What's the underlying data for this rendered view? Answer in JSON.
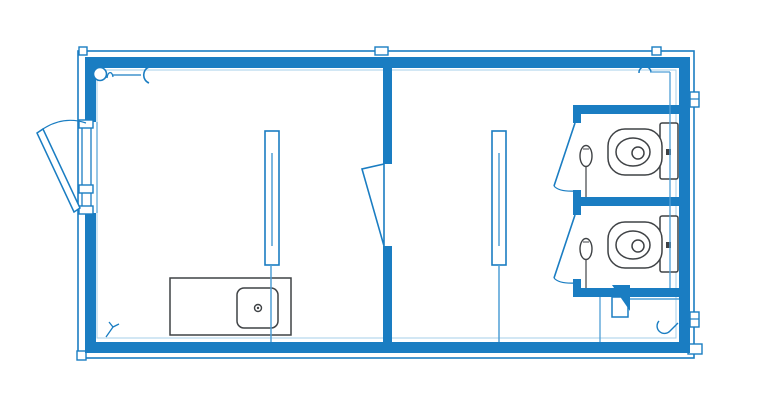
{
  "canvas": {
    "width": 768,
    "height": 420,
    "background": "#ffffff"
  },
  "palette": {
    "wall_blue": "#1a7dc2",
    "line_blue": "#4f9fd6",
    "faint_blue": "#a6cfe9",
    "fixture_gray": "#3f4245",
    "white": "#ffffff",
    "none": "none"
  },
  "floorplan": {
    "elements": [
      {
        "name": "outer-frame",
        "type": "rect",
        "x": 78,
        "y": 51,
        "w": 616,
        "h": 307,
        "stroke": "wall_blue",
        "sw": 1.6,
        "fill": "none"
      },
      {
        "name": "corner-joint-top-left",
        "type": "rect",
        "x": 79,
        "y": 47,
        "w": 8,
        "h": 8,
        "stroke": "wall_blue",
        "sw": 1.4,
        "fill": "white"
      },
      {
        "name": "joint-top-partition",
        "type": "rect",
        "x": 375,
        "y": 47,
        "w": 13,
        "h": 8,
        "stroke": "wall_blue",
        "sw": 1.4,
        "fill": "white"
      },
      {
        "name": "joint-top-right",
        "type": "rect",
        "x": 652,
        "y": 47,
        "w": 9,
        "h": 8,
        "stroke": "wall_blue",
        "sw": 1.4,
        "fill": "white"
      },
      {
        "name": "corner-joint-bottom-left",
        "type": "rect",
        "x": 77,
        "y": 351,
        "w": 9,
        "h": 9,
        "stroke": "wall_blue",
        "sw": 1.4,
        "fill": "white"
      },
      {
        "name": "corner-cap-bottom-right",
        "type": "rect",
        "x": 688,
        "y": 344,
        "w": 14,
        "h": 10,
        "stroke": "wall_blue",
        "sw": 1.4,
        "fill": "white"
      },
      {
        "name": "bracket-right-top",
        "type": "rect",
        "x": 690,
        "y": 92,
        "w": 9,
        "h": 15,
        "stroke": "wall_blue",
        "sw": 1.4,
        "fill": "white"
      },
      {
        "name": "bracket-right-top-line",
        "type": "line",
        "x1": 690,
        "y1": 99,
        "x2": 699,
        "y2": 99,
        "stroke": "wall_blue",
        "sw": 1.2
      },
      {
        "name": "bracket-right-bottom",
        "type": "rect",
        "x": 690,
        "y": 312,
        "w": 9,
        "h": 15,
        "stroke": "wall_blue",
        "sw": 1.4,
        "fill": "white"
      },
      {
        "name": "bracket-right-bottom-line",
        "type": "line",
        "x1": 690,
        "y1": 319,
        "x2": 699,
        "y2": 319,
        "stroke": "wall_blue",
        "sw": 1.2
      },
      {
        "name": "wall-top",
        "type": "rect",
        "x": 85,
        "y": 57,
        "w": 605,
        "h": 11,
        "fill": "wall_blue"
      },
      {
        "name": "wall-bottom",
        "type": "rect",
        "x": 85,
        "y": 342,
        "w": 605,
        "h": 11,
        "fill": "wall_blue"
      },
      {
        "name": "wall-left-upper",
        "type": "rect",
        "x": 85,
        "y": 57,
        "w": 11,
        "h": 65,
        "fill": "wall_blue"
      },
      {
        "name": "wall-left-lower",
        "type": "rect",
        "x": 85,
        "y": 213,
        "w": 11,
        "h": 140,
        "fill": "wall_blue"
      },
      {
        "name": "wall-right",
        "type": "rect",
        "x": 679,
        "y": 57,
        "w": 11,
        "h": 296,
        "fill": "wall_blue"
      },
      {
        "name": "inner-wall-face",
        "type": "rect",
        "x": 97,
        "y": 70,
        "w": 579,
        "h": 268,
        "stroke": "faint_blue",
        "sw": 1,
        "fill": "none"
      },
      {
        "name": "partition-wall-upper",
        "type": "rect",
        "x": 383,
        "y": 57,
        "w": 9,
        "h": 107,
        "fill": "wall_blue"
      },
      {
        "name": "partition-wall-lower",
        "type": "rect",
        "x": 383,
        "y": 246,
        "w": 9,
        "h": 107,
        "fill": "wall_blue"
      },
      {
        "name": "partition-door-leaf",
        "type": "polygon",
        "points": "384,164 362,169 384,246",
        "stroke": "wall_blue",
        "sw": 1.6,
        "fill": "white"
      },
      {
        "name": "stall-wall-top",
        "type": "rect",
        "x": 573,
        "y": 105,
        "w": 106,
        "h": 9,
        "fill": "wall_blue"
      },
      {
        "name": "stall-wall-top-post",
        "type": "rect",
        "x": 573,
        "y": 105,
        "w": 8,
        "h": 18,
        "fill": "wall_blue"
      },
      {
        "name": "stall-wall-middle",
        "type": "rect",
        "x": 573,
        "y": 197,
        "w": 106,
        "h": 9,
        "fill": "wall_blue"
      },
      {
        "name": "stall-wall-middle-post",
        "type": "rect",
        "x": 573,
        "y": 190,
        "w": 8,
        "h": 25,
        "fill": "wall_blue"
      },
      {
        "name": "stall-wall-bottom",
        "type": "rect",
        "x": 573,
        "y": 288,
        "w": 106,
        "h": 9,
        "fill": "wall_blue"
      },
      {
        "name": "stall-wall-bottom-post",
        "type": "rect",
        "x": 573,
        "y": 279,
        "w": 8,
        "h": 18,
        "fill": "wall_blue"
      },
      {
        "name": "stall1-door-leaf",
        "type": "line",
        "x1": 575,
        "y1": 123,
        "x2": 554,
        "y2": 186,
        "stroke": "wall_blue",
        "sw": 1.6
      },
      {
        "name": "stall1-door-swing",
        "type": "path",
        "d": "M554,186 Q559,192 576,191",
        "stroke": "wall_blue",
        "sw": 1.2,
        "fill": "none"
      },
      {
        "name": "stall2-door-leaf",
        "type": "line",
        "x1": 575,
        "y1": 215,
        "x2": 554,
        "y2": 278,
        "stroke": "wall_blue",
        "sw": 1.6
      },
      {
        "name": "stall2-door-swing",
        "type": "path",
        "d": "M554,278 Q559,284 576,283",
        "stroke": "wall_blue",
        "sw": 1.2,
        "fill": "none"
      },
      {
        "name": "entry-door-jamb",
        "type": "rect",
        "x": 82,
        "y": 122,
        "w": 9,
        "h": 91,
        "stroke": "wall_blue",
        "sw": 1.3,
        "fill": "white"
      },
      {
        "name": "entry-door-inner-line",
        "type": "line",
        "x1": 97,
        "y1": 122,
        "x2": 97,
        "y2": 213,
        "stroke": "line_blue",
        "sw": 1.2
      },
      {
        "name": "entry-door-hinge-top",
        "type": "rect",
        "x": 79,
        "y": 120,
        "w": 14,
        "h": 8,
        "stroke": "wall_blue",
        "sw": 1.4,
        "fill": "white"
      },
      {
        "name": "entry-door-hinge-middle",
        "type": "rect",
        "x": 79,
        "y": 185,
        "w": 14,
        "h": 8,
        "stroke": "wall_blue",
        "sw": 1.4,
        "fill": "white"
      },
      {
        "name": "entry-door-hinge-bottom",
        "type": "rect",
        "x": 79,
        "y": 206,
        "w": 14,
        "h": 8,
        "stroke": "wall_blue",
        "sw": 1.4,
        "fill": "white"
      },
      {
        "name": "entry-door-leaf",
        "type": "polygon",
        "points": "37,133 43,129 80,208 74,212",
        "stroke": "wall_blue",
        "sw": 1.5,
        "fill": "white"
      },
      {
        "name": "entry-door-swing",
        "type": "path",
        "d": "M40,131 Q62,115 86,123",
        "stroke": "wall_blue",
        "sw": 1.2,
        "fill": "none"
      },
      {
        "name": "lamp-symbol-circle",
        "type": "circle",
        "cx": 100,
        "cy": 74,
        "r": 6.5,
        "stroke": "wall_blue",
        "sw": 1.6,
        "fill": "white"
      },
      {
        "name": "lamp-symbol-squiggle",
        "type": "path",
        "d": "M107,78 c1,-7 5,-7 6,-1",
        "stroke": "wall_blue",
        "sw": 1.3,
        "fill": "none"
      },
      {
        "name": "lamp-symbol-lead",
        "type": "line",
        "x1": 113,
        "y1": 75,
        "x2": 141,
        "y2": 75,
        "stroke": "wall_blue",
        "sw": 1.3
      },
      {
        "name": "connection-bracket-symbol",
        "type": "path",
        "d": "M149,67 a8,8.5 0 0 0 0,16",
        "stroke": "wall_blue",
        "sw": 1.6,
        "fill": "none"
      },
      {
        "name": "socket-symbol-top-right",
        "type": "path",
        "d": "M639,73 a6,6 0 0 1 12,-1",
        "stroke": "wall_blue",
        "sw": 1.5,
        "fill": "none"
      },
      {
        "name": "socket-lead-top-right",
        "type": "line",
        "x1": 650,
        "y1": 72,
        "x2": 670,
        "y2": 72,
        "stroke": "line_blue",
        "sw": 1.2
      },
      {
        "name": "light-fixture-left",
        "type": "rect",
        "x": 265,
        "y": 131,
        "w": 14,
        "h": 134,
        "stroke": "wall_blue",
        "sw": 1.6,
        "fill": "white"
      },
      {
        "name": "light-fixture-left-tube",
        "type": "line",
        "x1": 272,
        "y1": 153,
        "x2": 272,
        "y2": 246,
        "stroke": "line_blue",
        "sw": 1.5
      },
      {
        "name": "light-fixture-right",
        "type": "rect",
        "x": 492,
        "y": 131,
        "w": 14,
        "h": 134,
        "stroke": "wall_blue",
        "sw": 1.6,
        "fill": "white"
      },
      {
        "name": "light-fixture-right-tube",
        "type": "line",
        "x1": 499,
        "y1": 153,
        "x2": 499,
        "y2": 246,
        "stroke": "line_blue",
        "sw": 1.5
      },
      {
        "name": "counter",
        "type": "rect",
        "x": 170,
        "y": 278,
        "w": 121,
        "h": 57,
        "stroke": "fixture_gray",
        "sw": 1.5,
        "fill": "white"
      },
      {
        "name": "sink-basin",
        "type": "rect",
        "x": 237,
        "y": 288,
        "w": 41,
        "h": 40,
        "rx": 7,
        "stroke": "fixture_gray",
        "sw": 1.5,
        "fill": "white"
      },
      {
        "name": "sink-drain",
        "type": "circle",
        "cx": 258,
        "cy": 308,
        "r": 3.5,
        "stroke": "fixture_gray",
        "sw": 1.4,
        "fill": "white"
      },
      {
        "name": "sink-drain-dot",
        "type": "circle",
        "cx": 258,
        "cy": 308,
        "r": 1.2,
        "fill": "fixture_gray"
      },
      {
        "name": "toilet1-cistern",
        "type": "rect",
        "x": 660,
        "y": 123,
        "w": 18,
        "h": 56,
        "rx": 2,
        "stroke": "fixture_gray",
        "sw": 1.5,
        "fill": "white"
      },
      {
        "name": "toilet1-bowl",
        "type": "rect",
        "x": 608,
        "y": 129,
        "w": 54,
        "h": 46,
        "rx": 17,
        "stroke": "fixture_gray",
        "sw": 1.5,
        "fill": "white"
      },
      {
        "name": "toilet1-bowl-inner",
        "type": "ellipse",
        "cx": 633,
        "cy": 152,
        "rx": 17,
        "ry": 14,
        "stroke": "fixture_gray",
        "sw": 1.5,
        "fill": "white"
      },
      {
        "name": "toilet1-flush",
        "type": "circle",
        "cx": 638,
        "cy": 153,
        "r": 6,
        "stroke": "fixture_gray",
        "sw": 1.5,
        "fill": "white"
      },
      {
        "name": "toilet1-button",
        "type": "rect",
        "x": 666,
        "y": 149,
        "w": 5,
        "h": 6,
        "fill": "fixture_gray"
      },
      {
        "name": "toilet2-cistern",
        "type": "rect",
        "x": 660,
        "y": 216,
        "w": 18,
        "h": 56,
        "rx": 2,
        "stroke": "fixture_gray",
        "sw": 1.5,
        "fill": "white"
      },
      {
        "name": "toilet2-bowl",
        "type": "rect",
        "x": 608,
        "y": 222,
        "w": 54,
        "h": 46,
        "rx": 17,
        "stroke": "fixture_gray",
        "sw": 1.5,
        "fill": "white"
      },
      {
        "name": "toilet2-bowl-inner",
        "type": "ellipse",
        "cx": 633,
        "cy": 245,
        "rx": 17,
        "ry": 14,
        "stroke": "fixture_gray",
        "sw": 1.5,
        "fill": "white"
      },
      {
        "name": "toilet2-flush",
        "type": "circle",
        "cx": 638,
        "cy": 246,
        "r": 6,
        "stroke": "fixture_gray",
        "sw": 1.5,
        "fill": "white"
      },
      {
        "name": "toilet2-button",
        "type": "rect",
        "x": 666,
        "y": 242,
        "w": 5,
        "h": 6,
        "fill": "fixture_gray"
      },
      {
        "name": "paper-holder1",
        "type": "ellipse",
        "cx": 586,
        "cy": 156,
        "rx": 6,
        "ry": 10.5,
        "stroke": "fixture_gray",
        "sw": 1.4,
        "fill": "white"
      },
      {
        "name": "paper-holder1-notch",
        "type": "line",
        "x1": 583,
        "y1": 149,
        "x2": 589,
        "y2": 149,
        "stroke": "fixture_gray",
        "sw": 1
      },
      {
        "name": "paper-holder1-line",
        "type": "line",
        "x1": 586,
        "y1": 166.5,
        "x2": 586,
        "y2": 197,
        "stroke": "fixture_gray",
        "sw": 1.2
      },
      {
        "name": "paper-holder2",
        "type": "ellipse",
        "cx": 586,
        "cy": 249,
        "rx": 6,
        "ry": 10.5,
        "stroke": "fixture_gray",
        "sw": 1.4,
        "fill": "white"
      },
      {
        "name": "paper-holder2-notch",
        "type": "line",
        "x1": 583,
        "y1": 242,
        "x2": 589,
        "y2": 242,
        "stroke": "fixture_gray",
        "sw": 1
      },
      {
        "name": "paper-holder2-line",
        "type": "line",
        "x1": 586,
        "y1": 259.5,
        "x2": 586,
        "y2": 288,
        "stroke": "fixture_gray",
        "sw": 1.2
      },
      {
        "name": "service-hatch-box",
        "type": "rect",
        "x": 612,
        "y": 297,
        "w": 16,
        "h": 20,
        "stroke": "wall_blue",
        "sw": 1.5,
        "fill": "white"
      },
      {
        "name": "service-hatch-flap",
        "type": "polygon",
        "points": "612,285 630,285 630,311",
        "fill": "wall_blue"
      },
      {
        "name": "service-stub-line",
        "type": "line",
        "x1": 630,
        "y1": 299,
        "x2": 679,
        "y2": 299,
        "stroke": "line_blue",
        "sw": 1.5
      },
      {
        "name": "service-line-left-room",
        "type": "line",
        "x1": 271,
        "y1": 265,
        "x2": 271,
        "y2": 342,
        "stroke": "line_blue",
        "sw": 1.5
      },
      {
        "name": "service-line-right-room",
        "type": "line",
        "x1": 499,
        "y1": 265,
        "x2": 499,
        "y2": 342,
        "stroke": "line_blue",
        "sw": 1.5
      },
      {
        "name": "service-line-stalls",
        "type": "line",
        "x1": 670,
        "y1": 72,
        "x2": 670,
        "y2": 288,
        "stroke": "line_blue",
        "sw": 1.3
      },
      {
        "name": "service-line-hatch",
        "type": "line",
        "x1": 600,
        "y1": 297,
        "x2": 600,
        "y2": 342,
        "stroke": "line_blue",
        "sw": 1.3
      },
      {
        "name": "switch-symbol-bottom-left",
        "type": "path",
        "d": "M106,337 L113,327 M109,322 L113,327 L119,324",
        "stroke": "wall_blue",
        "sw": 1.3,
        "fill": "none"
      },
      {
        "name": "socket-symbol-bottom-right",
        "type": "path",
        "d": "M659,321 a7,7 0 0 0 11,10 M670,331 L678,323",
        "stroke": "wall_blue",
        "sw": 1.4,
        "fill": "none"
      }
    ]
  }
}
